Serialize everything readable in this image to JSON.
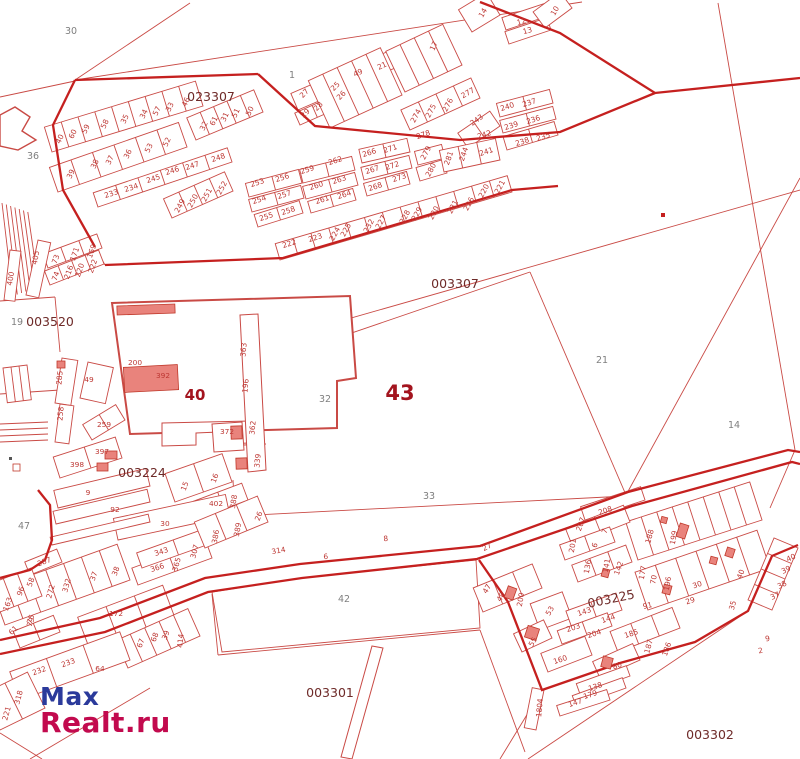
{
  "title": "Cadastral map",
  "watermark": {
    "line1": "Max",
    "line2": "Realt.ru",
    "color1": "#2b3a9b",
    "color2": "#c20a4e"
  },
  "colors": {
    "thin_line": "#c94a45",
    "road_line": "#c5201f",
    "parcel_label": "#bd3733",
    "area_label": "#7f7f7f",
    "quarter_label": "#6e2a28",
    "big_label": "#a3141e",
    "building_fill": "#e9837c",
    "building_stroke": "#c0392b",
    "background": "#ffffff"
  },
  "quarter_labels": [
    {
      "text": "023307",
      "x": 211,
      "y": 101,
      "r": 0
    },
    {
      "text": "003520",
      "x": 50,
      "y": 326,
      "r": 0
    },
    {
      "text": "003307",
      "x": 455,
      "y": 288,
      "r": 0
    },
    {
      "text": "003224",
      "x": 142,
      "y": 477,
      "r": 0
    },
    {
      "text": "003225",
      "x": 612,
      "y": 603,
      "r": -12
    },
    {
      "text": "003301",
      "x": 330,
      "y": 697,
      "r": 0
    },
    {
      "text": "003302",
      "x": 710,
      "y": 739,
      "r": 0
    }
  ],
  "area_labels": [
    {
      "text": "30",
      "x": 71,
      "y": 34
    },
    {
      "text": "36",
      "x": 33,
      "y": 159
    },
    {
      "text": "1",
      "x": 292,
      "y": 78
    },
    {
      "text": "19",
      "x": 17,
      "y": 325
    },
    {
      "text": "32",
      "x": 325,
      "y": 402
    },
    {
      "text": "21",
      "x": 602,
      "y": 363
    },
    {
      "text": "14",
      "x": 734,
      "y": 428
    },
    {
      "text": "33",
      "x": 429,
      "y": 499
    },
    {
      "text": "42",
      "x": 344,
      "y": 602
    },
    {
      "text": "47",
      "x": 24,
      "y": 529
    }
  ],
  "big_labels": [
    {
      "text": "40",
      "x": 195,
      "y": 400,
      "size": 15
    },
    {
      "text": "43",
      "x": 400,
      "y": 400,
      "size": 21
    }
  ],
  "parcel_labels": [
    [
      "40",
      62,
      140,
      -65
    ],
    [
      "60",
      75,
      135,
      -65
    ],
    [
      "59",
      88,
      130,
      -65
    ],
    [
      "58",
      107,
      125,
      -65
    ],
    [
      "35",
      127,
      120,
      -65
    ],
    [
      "34",
      146,
      115,
      -65
    ],
    [
      "57",
      159,
      112,
      -65
    ],
    [
      "33",
      172,
      108,
      -65
    ],
    [
      "46",
      188,
      103,
      -65
    ],
    [
      "39",
      73,
      175,
      -65
    ],
    [
      "38",
      97,
      165,
      -65
    ],
    [
      "37",
      112,
      161,
      -65
    ],
    [
      "36",
      130,
      155,
      -65
    ],
    [
      "53",
      151,
      149,
      -65
    ],
    [
      "52",
      169,
      143,
      -65
    ],
    [
      "32",
      206,
      127,
      -65
    ],
    [
      "61",
      216,
      122,
      -65
    ],
    [
      "31",
      227,
      118,
      -65
    ],
    [
      "51",
      238,
      114,
      -65
    ],
    [
      "50",
      252,
      112,
      -65
    ],
    [
      "27",
      306,
      95,
      -45
    ],
    [
      "29",
      307,
      115,
      -45
    ],
    [
      "28",
      320,
      108,
      -45
    ],
    [
      "25",
      337,
      88,
      -45
    ],
    [
      "26",
      343,
      97,
      -45
    ],
    [
      "49",
      359,
      75,
      -25
    ],
    [
      "21",
      383,
      68,
      -25
    ],
    [
      "17",
      436,
      47,
      -65
    ],
    [
      "14",
      485,
      14,
      -60
    ],
    [
      "12",
      522,
      24,
      -15
    ],
    [
      "13",
      528,
      33,
      -15
    ],
    [
      "10",
      557,
      12,
      -60
    ],
    [
      "233",
      112,
      196,
      -18
    ],
    [
      "234",
      132,
      190,
      -18
    ],
    [
      "245",
      154,
      181,
      -18
    ],
    [
      "246",
      173,
      173,
      -18
    ],
    [
      "247",
      193,
      168,
      -18
    ],
    [
      "248",
      219,
      160,
      -18
    ],
    [
      "249",
      182,
      207,
      -62
    ],
    [
      "250",
      195,
      202,
      -62
    ],
    [
      "251",
      209,
      196,
      -62
    ],
    [
      "252",
      224,
      189,
      -62
    ],
    [
      "253",
      258,
      185,
      -18
    ],
    [
      "256",
      283,
      180,
      -18
    ],
    [
      "259",
      308,
      172,
      -18
    ],
    [
      "254",
      260,
      202,
      -18
    ],
    [
      "257",
      285,
      197,
      -18
    ],
    [
      "258",
      289,
      213,
      -18
    ],
    [
      "255",
      267,
      219,
      -18
    ],
    [
      "262",
      336,
      163,
      -18
    ],
    [
      "260",
      317,
      188,
      -18
    ],
    [
      "263",
      340,
      182,
      -18
    ],
    [
      "261",
      323,
      202,
      -18
    ],
    [
      "264",
      345,
      197,
      -18
    ],
    [
      "266",
      370,
      155,
      -18
    ],
    [
      "271",
      391,
      151,
      -18
    ],
    [
      "267",
      373,
      172,
      -18
    ],
    [
      "272",
      393,
      168,
      -18
    ],
    [
      "268",
      376,
      189,
      -18
    ],
    [
      "273",
      400,
      180,
      -18
    ],
    [
      "279",
      428,
      154,
      -62
    ],
    [
      "280",
      433,
      171,
      -62
    ],
    [
      "281",
      451,
      159,
      -70
    ],
    [
      "244",
      466,
      155,
      -70
    ],
    [
      "241",
      487,
      154,
      -18
    ],
    [
      "274",
      418,
      117,
      -62
    ],
    [
      "275",
      433,
      112,
      -62
    ],
    [
      "276",
      450,
      106,
      -62
    ],
    [
      "277",
      469,
      95,
      -30
    ],
    [
      "278",
      424,
      137,
      -18
    ],
    [
      "243",
      478,
      122,
      -35
    ],
    [
      "242",
      485,
      137,
      -18
    ],
    [
      "240",
      508,
      109,
      -18
    ],
    [
      "237",
      530,
      105,
      -18
    ],
    [
      "239",
      512,
      128,
      -18
    ],
    [
      "236",
      534,
      122,
      -18
    ],
    [
      "238",
      523,
      144,
      -18
    ],
    [
      "235",
      544,
      139,
      -18
    ],
    [
      "222",
      290,
      246,
      -18
    ],
    [
      "223",
      316,
      240,
      -18
    ],
    [
      "224",
      337,
      235,
      -62
    ],
    [
      "225",
      348,
      231,
      -62
    ],
    [
      "232",
      371,
      227,
      -62
    ],
    [
      "227",
      383,
      223,
      -62
    ],
    [
      "228",
      407,
      218,
      -62
    ],
    [
      "229",
      419,
      215,
      -62
    ],
    [
      "230",
      436,
      214,
      -62
    ],
    [
      "231",
      455,
      208,
      -62
    ],
    [
      "226",
      471,
      205,
      -62
    ],
    [
      "220",
      486,
      192,
      -62
    ],
    [
      "221",
      502,
      188,
      -62
    ],
    [
      "400",
      13,
      279,
      -80
    ],
    [
      "405",
      38,
      258,
      -80
    ],
    [
      "73",
      58,
      260,
      -70
    ],
    [
      "171",
      77,
      255,
      -70
    ],
    [
      "169",
      94,
      252,
      -70
    ],
    [
      "74",
      58,
      277,
      -70
    ],
    [
      "216",
      71,
      273,
      -70
    ],
    [
      "220",
      82,
      271,
      -70
    ],
    [
      "222",
      95,
      267,
      -70
    ],
    [
      "200",
      135,
      365,
      0
    ],
    [
      "392",
      163,
      378,
      0
    ],
    [
      "363",
      246,
      350,
      -85
    ],
    [
      "196",
      248,
      386,
      -85
    ],
    [
      "362",
      255,
      428,
      -85
    ],
    [
      "339",
      260,
      461,
      -85
    ],
    [
      "372",
      227,
      434,
      0
    ],
    [
      "285",
      62,
      378,
      -85
    ],
    [
      "49",
      89,
      382,
      0
    ],
    [
      "258",
      63,
      414,
      -85
    ],
    [
      "259",
      104,
      427,
      0
    ],
    [
      "397",
      102,
      454,
      0
    ],
    [
      "398",
      77,
      467,
      0
    ],
    [
      "9",
      88,
      495,
      0
    ],
    [
      "92",
      115,
      512,
      0
    ],
    [
      "15",
      187,
      487,
      -70
    ],
    [
      "16",
      217,
      479,
      -70
    ],
    [
      "402",
      216,
      506,
      0
    ],
    [
      "388",
      236,
      502,
      -80
    ],
    [
      "30",
      165,
      526,
      0
    ],
    [
      "343",
      162,
      554,
      -18
    ],
    [
      "366",
      158,
      570,
      -18
    ],
    [
      "365",
      179,
      565,
      -75
    ],
    [
      "307",
      197,
      552,
      -75
    ],
    [
      "386",
      218,
      537,
      -80
    ],
    [
      "389",
      240,
      530,
      -80
    ],
    [
      "26",
      261,
      517,
      -70
    ],
    [
      "314",
      279,
      553,
      -10
    ],
    [
      "287",
      45,
      564,
      -20
    ],
    [
      "58",
      33,
      583,
      -70
    ],
    [
      "96",
      23,
      592,
      -70
    ],
    [
      "163",
      10,
      605,
      -70
    ],
    [
      "75",
      33,
      620,
      -70
    ],
    [
      "61",
      15,
      632,
      -45
    ],
    [
      "272",
      53,
      592,
      -75
    ],
    [
      "332",
      69,
      586,
      -75
    ],
    [
      "37",
      96,
      577,
      -70
    ],
    [
      "38",
      118,
      572,
      -70
    ],
    [
      "172",
      116,
      616,
      0
    ],
    [
      "67",
      143,
      644,
      -70
    ],
    [
      "68",
      157,
      638,
      -70
    ],
    [
      "79",
      33,
      623,
      -70
    ],
    [
      "232",
      40,
      673,
      -20
    ],
    [
      "233",
      69,
      665,
      -20
    ],
    [
      "64",
      100,
      671,
      0
    ],
    [
      "39",
      168,
      636,
      -70
    ],
    [
      "414",
      183,
      641,
      -85
    ],
    [
      "318",
      21,
      698,
      -75
    ],
    [
      "221",
      9,
      714,
      -75
    ],
    [
      "6",
      326,
      559,
      -5
    ],
    [
      "8",
      386,
      541,
      -5
    ],
    [
      "27",
      488,
      549,
      -28
    ],
    [
      "91",
      648,
      608,
      -12
    ],
    [
      "9",
      768,
      641,
      -12
    ],
    [
      "2",
      761,
      653,
      -12
    ],
    [
      "208",
      606,
      513,
      -18
    ],
    [
      "207",
      583,
      525,
      -70
    ],
    [
      "7",
      607,
      532,
      -70
    ],
    [
      "201",
      575,
      546,
      -80
    ],
    [
      "6",
      597,
      546,
      -70
    ],
    [
      "136",
      590,
      567,
      -80
    ],
    [
      "141",
      609,
      566,
      -80
    ],
    [
      "142",
      621,
      569,
      -70
    ],
    [
      "47",
      489,
      590,
      -60
    ],
    [
      "48",
      503,
      598,
      -60
    ],
    [
      "200",
      523,
      600,
      -80
    ],
    [
      "53",
      552,
      612,
      -60
    ],
    [
      "55",
      535,
      643,
      -60
    ],
    [
      "160",
      561,
      662,
      -18
    ],
    [
      "143",
      585,
      614,
      -18
    ],
    [
      "144",
      609,
      621,
      -18
    ],
    [
      "203",
      574,
      630,
      -18
    ],
    [
      "204",
      595,
      636,
      -18
    ],
    [
      "185",
      632,
      636,
      -18
    ],
    [
      "187",
      651,
      647,
      -75
    ],
    [
      "186",
      669,
      650,
      -70
    ],
    [
      "80",
      618,
      668,
      -18
    ],
    [
      "138",
      596,
      689,
      -18
    ],
    [
      "179",
      591,
      697,
      -18
    ],
    [
      "147",
      576,
      705,
      -18
    ],
    [
      "1804",
      542,
      708,
      -85
    ],
    [
      "188",
      652,
      537,
      -75
    ],
    [
      "199",
      676,
      538,
      -80
    ],
    [
      "177",
      645,
      573,
      -80
    ],
    [
      "70",
      656,
      580,
      -80
    ],
    [
      "196",
      670,
      584,
      -80
    ],
    [
      "30",
      698,
      587,
      -18
    ],
    [
      "29",
      691,
      603,
      -18
    ],
    [
      "40",
      743,
      575,
      -70
    ],
    [
      "35",
      735,
      606,
      -75
    ],
    [
      "40",
      792,
      560,
      -25
    ],
    [
      "39",
      787,
      572,
      -25
    ],
    [
      "38",
      783,
      587,
      -25
    ],
    [
      "37",
      776,
      598,
      -25
    ]
  ]
}
